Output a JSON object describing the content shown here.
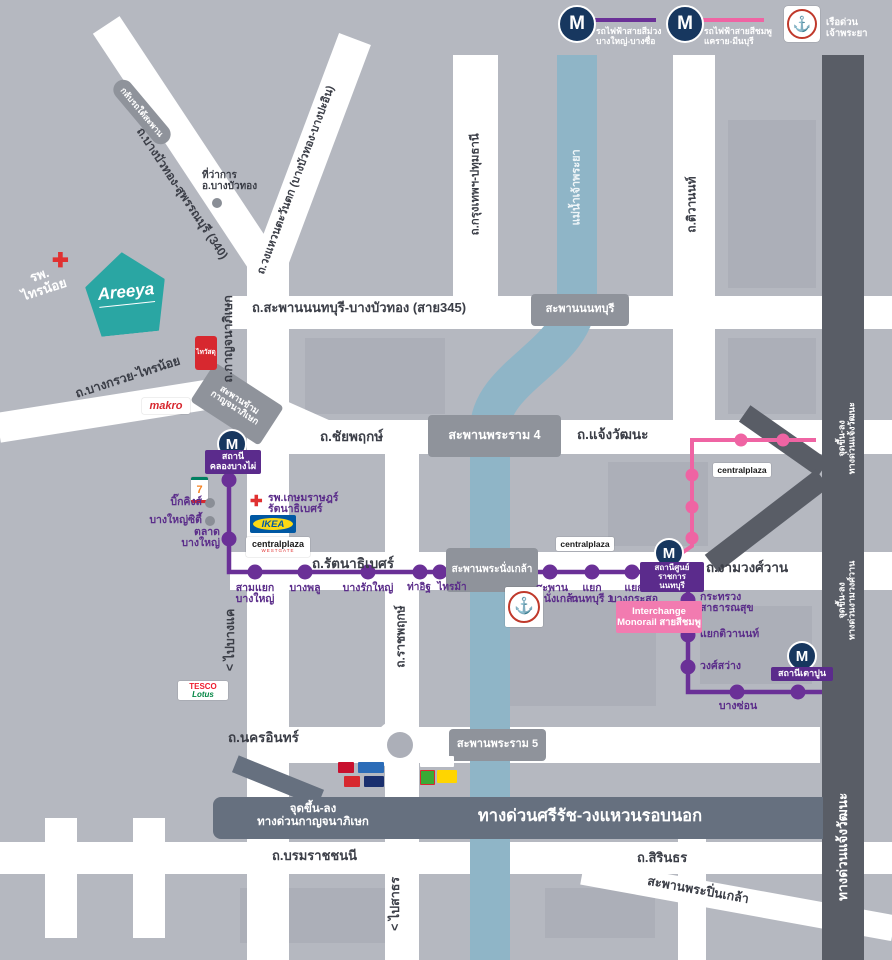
{
  "misc": {
    "m": "M"
  },
  "colors": {
    "background": "#b5b8c0",
    "road_white": "#ffffff",
    "river_blue": "#8fb5c7",
    "expressway_dark": "#595d66",
    "expressway_slate": "#66707f",
    "bridge_gray": "#8f939b",
    "purple_line": "#6a3097",
    "purple_label": "#5b2d8a",
    "pink_line": "#ef64a3",
    "m_icon_navy": "#17375f",
    "areeya_teal": "#2aa6a3",
    "hospital_red": "#e03131"
  },
  "legend": {
    "purple": {
      "line1": "รถไฟฟ้าสายสีม่วง",
      "line2": "บางใหญ่-บางซื่อ"
    },
    "pink": {
      "line1": "รถไฟฟ้าสายสีชมพู",
      "line2": "แคราย-มีนบุรี"
    },
    "boat": {
      "label": "เรือด่วนเจ้าพระยา"
    }
  },
  "roads": {
    "r340": "ถ.บางบัวทอง-สุพรรณบุรี (340)",
    "west_ring": "ถ.วงแหวนตะวันตก (บางบัวทอง-บางปะอิน)",
    "sai345": "ถ.สะพานนนทบุรี-บางบัวทอง (สาย345)",
    "kanchanaphisek": "ถ.กาญจนาภิเษก",
    "bangkruai_sainoi": "ถ.บางกรวย-ไทรน้อย",
    "chaiyapruek": "ถ.ชัยพฤกษ์",
    "chaengwattana": "ถ.แจ้งวัฒนะ",
    "krungthep_pathum": "ถ.กรุงเทพฯ-ปทุมธานี",
    "tiwanon": "ถ.ติวานนท์",
    "rattanathibet": "ถ.รัตนาธิเบศร์",
    "ngamwongwan": "ถ.งามวงศ์วาน",
    "ratchaphruek": "ถ.ราชพฤกษ์",
    "nakhon_in": "ถ.นครอินทร์",
    "borommaratchachonnani": "ถ.บรมราชชนนี",
    "sirindhorn": "ถ.สิรินธร",
    "to_bangkhae": "< ไปบางแค",
    "to_sathon": "< ไปสาธร",
    "river": "แม่น้ำเจ้าพระยา"
  },
  "bridges": {
    "nonthaburi": "สะพานนนทบุรี",
    "rama4": "สะพานพระราม 4",
    "phra_nangklao": "สะพานพระนั่งเกล้า",
    "rama5": "สะพานพระราม 5",
    "pinklao": "สะพานพระปิ่นเกล้า",
    "kanchana_cross_l1": "สะพานข้าม",
    "kanchana_cross_l2": "กาญจนาภิเษก",
    "u_turn": "กลับรถใต้สะพาน"
  },
  "expressways": {
    "si_rat_name": "ทางด่วนศรีรัช-วงแหวนรอบนอก",
    "kanchana_ramp_l1": "จุดขึ้น-ลง",
    "kanchana_ramp_l2": "ทางด่วนกาญจนาภิเษก",
    "chaeng_ramp_l1": "จุดขึ้น-ลง",
    "chaeng_ramp_l2": "ทางด่วนแจ้งวัฒนะ",
    "ngam_ramp_l1": "จุดขึ้น-ลง",
    "ngam_ramp_l2": "ทางด่วนงามวงศ์วาน",
    "chaeng_name": "ทางด่วนแจ้งวัฒนะ"
  },
  "stations": {
    "khlong_bang_phai_l1": "สถานี",
    "khlong_bang_phai_l2": "คลองบางไผ่",
    "talad_l1": "ตลาด",
    "talad_l2": "บางใหญ่",
    "sam_yaek_l1": "สามแยก",
    "sam_yaek_l2": "บางใหญ่",
    "bang_phlu": "บางพลู",
    "bang_rak_yai": "บางรักใหญ่",
    "tha_it": "ท่าอิฐ",
    "sai_ma": "ไทรม้า",
    "saphan_l1": "สะพาน",
    "saphan_l2": "พระนั่งเกล้า",
    "nonthaburi1_l1": "แยก",
    "nonthaburi1_l2": "นนทบุรี 1",
    "bang_krasor_l1": "แยก",
    "bang_krasor_l2": "บางกระสอ",
    "civic_l1": "สถานีศูนย์ราชการ",
    "civic_l2": "นนทบุรี",
    "health_l1": "กระทรวง",
    "health_l2": "สาธารณสุข",
    "yaek_tiwanon": "แยกติวานนท์",
    "wong_sawang": "วงศ์สว่าง",
    "bang_son": "บางซ่อน",
    "tao_poon": "สถานีเตาปูน",
    "interchange_l1": "Interchange",
    "interchange_l2": "Monorail สายสีชมพู"
  },
  "landmarks": {
    "areeya": "Areeya",
    "sainoi_hospital_l1": "รพ.",
    "sainoi_hospital_l2": "ไทรน้อย",
    "district_office_l1": "ที่ว่าการ",
    "district_office_l2": "อ.บางบัวทอง",
    "thaiwatsadu": "ไทวัสดุ",
    "makro": "makro",
    "seven": "7",
    "big_kings": "บิ๊กคิงส์",
    "bangyai_city": "บางใหญ่ซิตี้",
    "kasemrad_l1": "รพ.เกษมราษฎร์",
    "kasemrad_l2": "รัตนาธิเบศร์",
    "ikea": "IKEA",
    "central_main": "centralplaza",
    "central_westgate_sub": "WESTGATE",
    "tesco_l1": "TESCO",
    "tesco_l2": "Lotus",
    "anchor": "⚓"
  }
}
